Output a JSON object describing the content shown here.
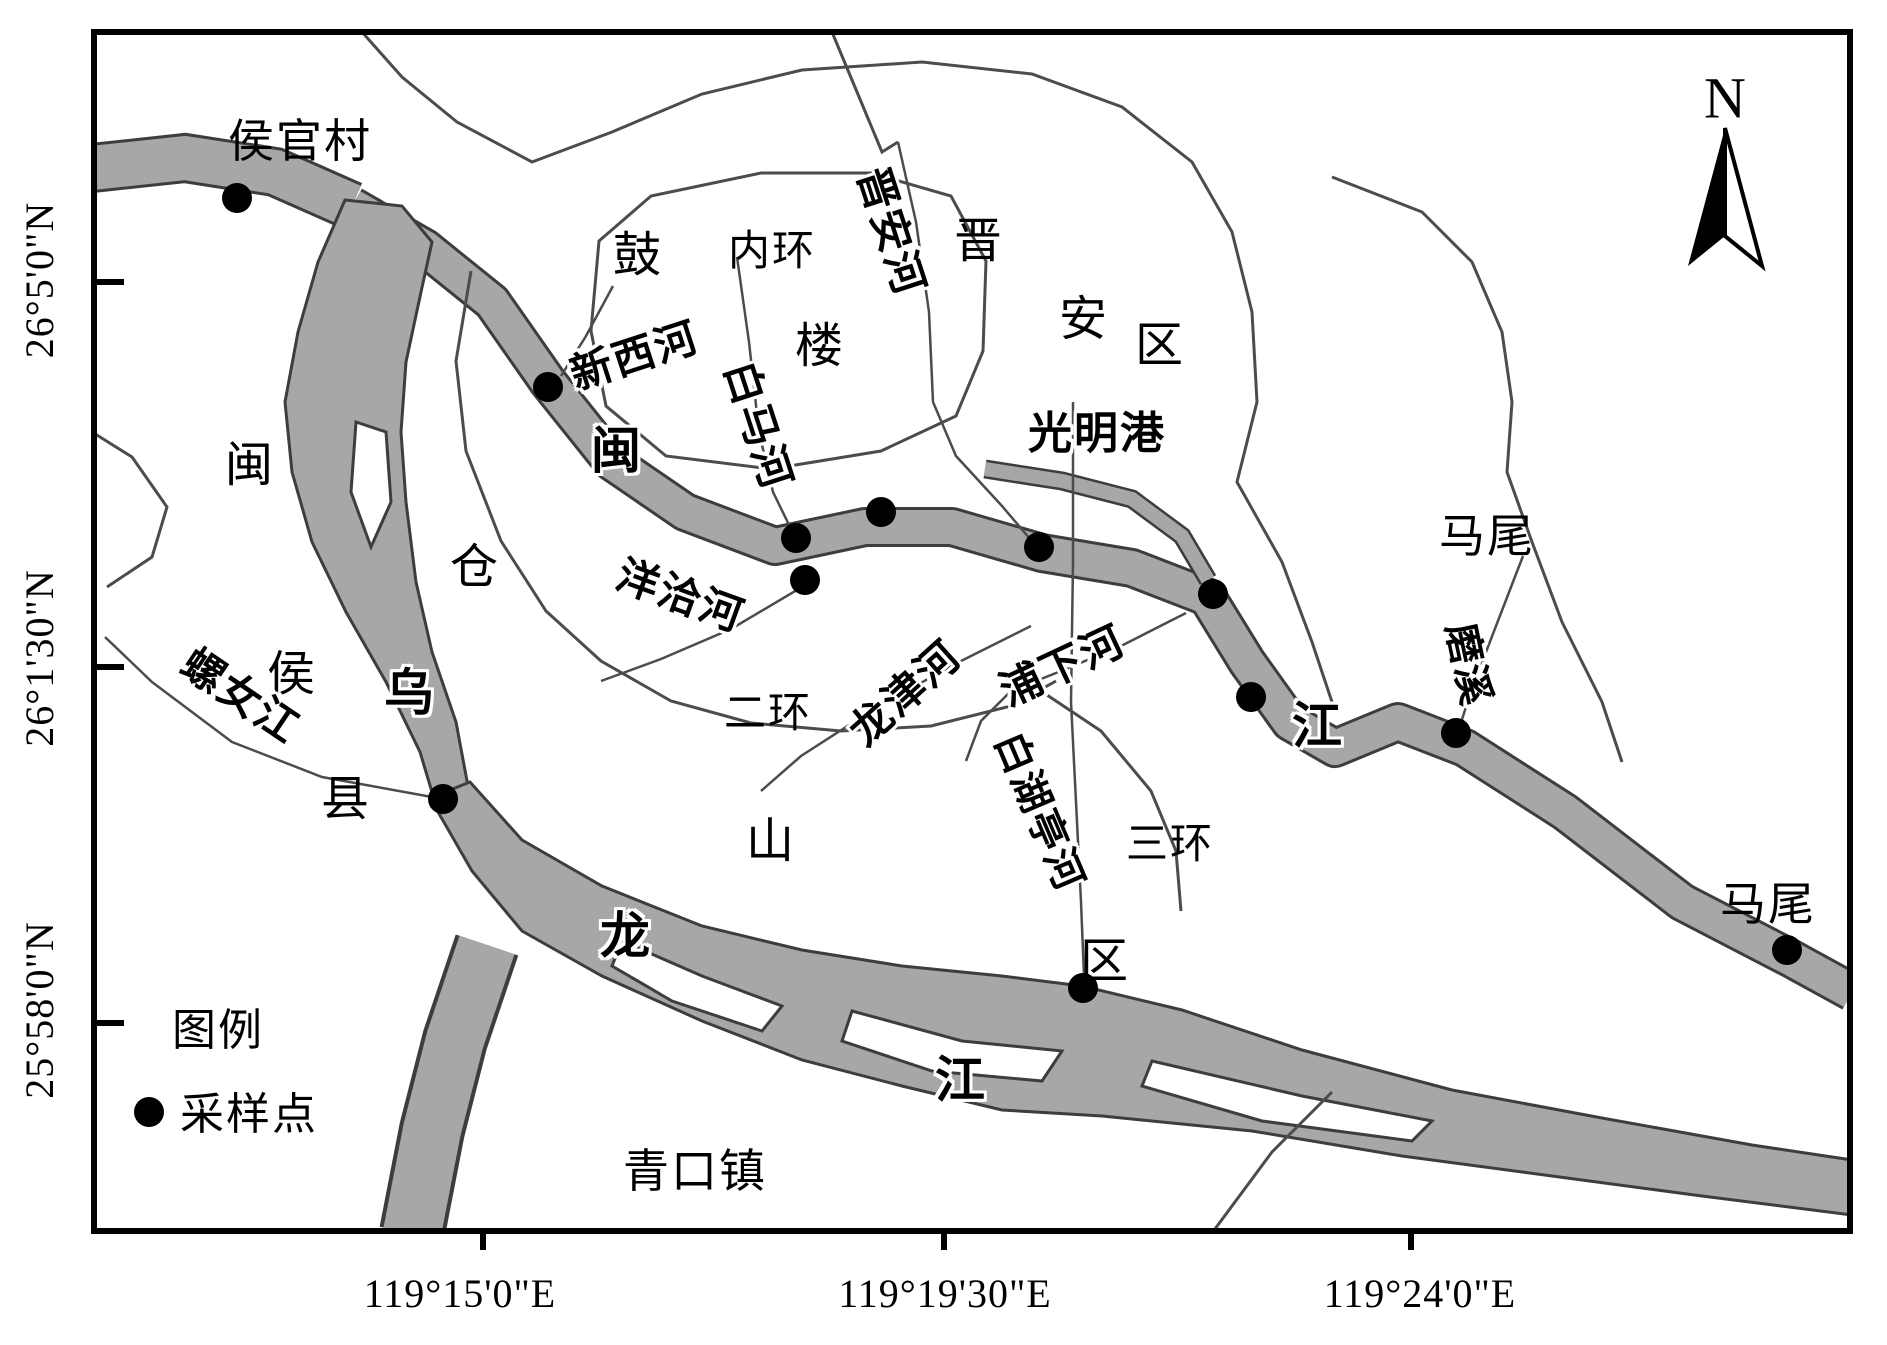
{
  "figure": {
    "north_label": "N",
    "legend": {
      "title": "图例",
      "sample_point_label": "采样点"
    },
    "colors": {
      "river_fill": "#a7a7a7",
      "river_edge": "#3d3d3d",
      "line": "#4c4c4c",
      "frame": "#000000",
      "point": "#000000"
    },
    "axes": {
      "latitude": [
        {
          "text": "26°5'0\"N",
          "y": 280
        },
        {
          "text": "26°1'30\"N",
          "y": 658
        },
        {
          "text": "25°58'0\"N",
          "y": 1010
        }
      ],
      "longitude": [
        {
          "text": "119°15'0\"E",
          "x": 460
        },
        {
          "text": "119°19'30\"E",
          "x": 945
        },
        {
          "text": "119°24'0\"E",
          "x": 1420
        }
      ]
    },
    "labels": [
      {
        "id": "houguan-village",
        "text": "侯官村",
        "x": 300,
        "y": 142,
        "rot": 0,
        "size": 46,
        "halo": false
      },
      {
        "id": "gulou-gu",
        "text": "鼓",
        "x": 638,
        "y": 256,
        "rot": 0,
        "size": 48,
        "halo": false
      },
      {
        "id": "gulou-lou",
        "text": "楼",
        "x": 820,
        "y": 347,
        "rot": 0,
        "size": 48,
        "halo": false
      },
      {
        "id": "inner-ring",
        "text": "内环",
        "x": 772,
        "y": 252,
        "rot": 0,
        "size": 42,
        "halo": false
      },
      {
        "id": "jinan-district-jin",
        "text": "晋",
        "x": 979,
        "y": 242,
        "rot": 0,
        "size": 48,
        "halo": false
      },
      {
        "id": "jinan-district-an",
        "text": "安",
        "x": 1084,
        "y": 320,
        "rot": 0,
        "size": 48,
        "halo": false
      },
      {
        "id": "jinan-district-qu",
        "text": "区",
        "x": 1160,
        "y": 346,
        "rot": 0,
        "size": 48,
        "halo": false
      },
      {
        "id": "guangming-port",
        "text": "光明港",
        "x": 1097,
        "y": 434,
        "rot": 0,
        "size": 44,
        "halo": true
      },
      {
        "id": "mawei-district",
        "text": "马尾",
        "x": 1487,
        "y": 537,
        "rot": 0,
        "size": 46,
        "halo": false
      },
      {
        "id": "minhou-min",
        "text": "闽",
        "x": 250,
        "y": 466,
        "rot": 0,
        "size": 48,
        "halo": false
      },
      {
        "id": "minhou-hou",
        "text": "侯",
        "x": 292,
        "y": 675,
        "rot": 0,
        "size": 48,
        "halo": false
      },
      {
        "id": "minhou-xian",
        "text": "县",
        "x": 346,
        "y": 800,
        "rot": 0,
        "size": 48,
        "halo": false
      },
      {
        "id": "cangshan-cang",
        "text": "仓",
        "x": 475,
        "y": 568,
        "rot": 0,
        "size": 48,
        "halo": false
      },
      {
        "id": "cangshan-shan",
        "text": "山",
        "x": 771,
        "y": 842,
        "rot": 0,
        "size": 48,
        "halo": false
      },
      {
        "id": "cangshan-qu",
        "text": "区",
        "x": 1105,
        "y": 962,
        "rot": 0,
        "size": 48,
        "halo": false
      },
      {
        "id": "second-ring",
        "text": "二环",
        "x": 768,
        "y": 714,
        "rot": 0,
        "size": 42,
        "halo": false
      },
      {
        "id": "third-ring",
        "text": "三环",
        "x": 1170,
        "y": 845,
        "rot": 0,
        "size": 42,
        "halo": false
      },
      {
        "id": "qingkou-town",
        "text": "青口镇",
        "x": 695,
        "y": 1172,
        "rot": 0,
        "size": 46,
        "halo": false
      },
      {
        "id": "mawei-town",
        "text": "马尾",
        "x": 1768,
        "y": 905,
        "rot": 0,
        "size": 46,
        "halo": false
      },
      {
        "id": "minjiang-min",
        "text": "闽",
        "x": 617,
        "y": 451,
        "rot": 0,
        "size": 50,
        "halo": true
      },
      {
        "id": "minjiang-jiang",
        "text": "江",
        "x": 1318,
        "y": 726,
        "rot": 0,
        "size": 50,
        "halo": true
      },
      {
        "id": "wulongjiang-wu",
        "text": "乌",
        "x": 410,
        "y": 693,
        "rot": 0,
        "size": 50,
        "halo": true
      },
      {
        "id": "wulongjiang-long",
        "text": "龙",
        "x": 626,
        "y": 936,
        "rot": 0,
        "size": 50,
        "halo": true
      },
      {
        "id": "wulongjiang-jiang",
        "text": "江",
        "x": 961,
        "y": 1080,
        "rot": 0,
        "size": 50,
        "halo": true
      },
      {
        "id": "jinan-river",
        "text": "晋安河",
        "x": 890,
        "y": 232,
        "rot": 72,
        "size": 42,
        "halo": true
      },
      {
        "id": "baima-river",
        "text": "白马河",
        "x": 757,
        "y": 426,
        "rot": 72,
        "size": 42,
        "halo": true
      },
      {
        "id": "xinxi-river",
        "text": "新西河",
        "x": 635,
        "y": 357,
        "rot": -18,
        "size": 42,
        "halo": true
      },
      {
        "id": "yangqia-river",
        "text": "洋洽河",
        "x": 680,
        "y": 597,
        "rot": 20,
        "size": 42,
        "halo": true
      },
      {
        "id": "longjin-river",
        "text": "龙津河",
        "x": 906,
        "y": 694,
        "rot": -42,
        "size": 42,
        "halo": true
      },
      {
        "id": "puxia-river",
        "text": "浦下河",
        "x": 1063,
        "y": 667,
        "rot": -25,
        "size": 42,
        "halo": true
      },
      {
        "id": "baihuting-river",
        "text": "白湖亭河",
        "x": 1039,
        "y": 812,
        "rot": 67,
        "size": 40,
        "halo": true
      },
      {
        "id": "moxi-river",
        "text": "磨溪",
        "x": 1468,
        "y": 665,
        "rot": 78,
        "size": 40,
        "halo": true
      },
      {
        "id": "luonv-river",
        "text": "螺女江",
        "x": 240,
        "y": 697,
        "rot": 34,
        "size": 42,
        "halo": true
      }
    ],
    "sampling_points": [
      {
        "x": 237,
        "y": 198
      },
      {
        "x": 548,
        "y": 387
      },
      {
        "x": 796,
        "y": 538
      },
      {
        "x": 881,
        "y": 512
      },
      {
        "x": 805,
        "y": 580
      },
      {
        "x": 1039,
        "y": 547
      },
      {
        "x": 1213,
        "y": 594
      },
      {
        "x": 1251,
        "y": 697
      },
      {
        "x": 1456,
        "y": 733
      },
      {
        "x": 1083,
        "y": 988
      },
      {
        "x": 443,
        "y": 799
      },
      {
        "x": 1787,
        "y": 950
      }
    ]
  }
}
